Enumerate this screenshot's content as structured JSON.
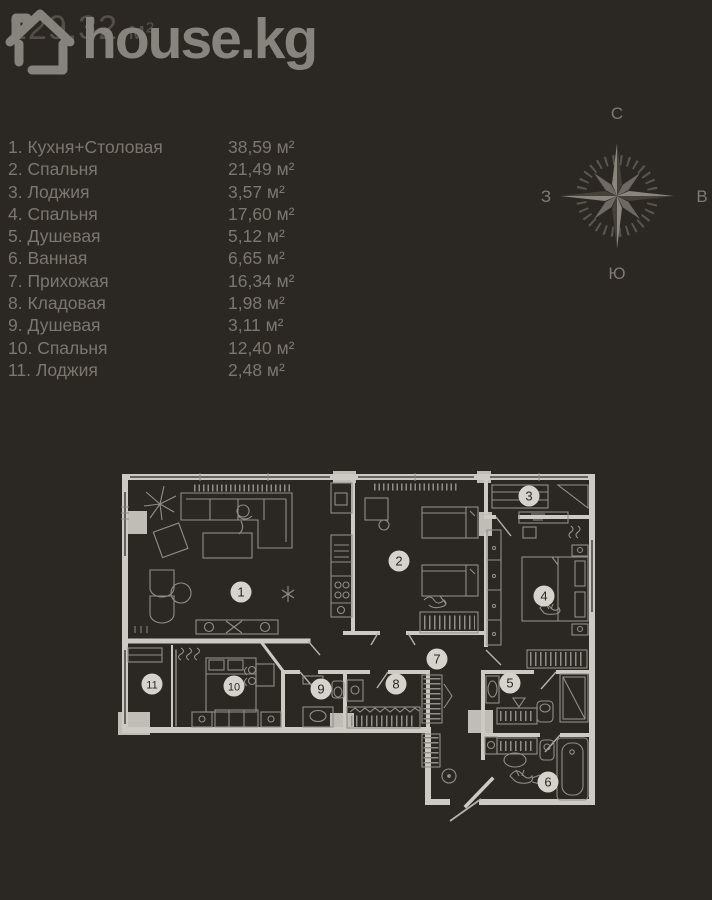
{
  "header": {
    "area_value": "129,32",
    "area_unit": "м²",
    "brand": "house.kg"
  },
  "compass": {
    "north": "С",
    "east": "В",
    "south": "Ю",
    "west": "З"
  },
  "rooms": [
    {
      "num": "1",
      "name": "Кухня+Столовая",
      "area": "38,59 м²",
      "x": 241,
      "y": 592
    },
    {
      "num": "2",
      "name": "Спальня",
      "area": "21,49 м²",
      "x": 399,
      "y": 561
    },
    {
      "num": "3",
      "name": "Лоджия",
      "area": "3,57 м²",
      "x": 529,
      "y": 496
    },
    {
      "num": "4",
      "name": "Спальня",
      "area": "17,60 м²",
      "x": 544,
      "y": 596
    },
    {
      "num": "5",
      "name": "Душевая",
      "area": "5,12 м²",
      "x": 510,
      "y": 683
    },
    {
      "num": "6",
      "name": "Ванная",
      "area": "6,65 м²",
      "x": 548,
      "y": 782
    },
    {
      "num": "7",
      "name": "Прихожая",
      "area": "16,34 м²",
      "x": 437,
      "y": 659
    },
    {
      "num": "8",
      "name": "Кладовая",
      "area": "1,98 м²",
      "x": 396,
      "y": 684
    },
    {
      "num": "9",
      "name": "Душевая",
      "area": "3,11 м²",
      "x": 321,
      "y": 689
    },
    {
      "num": "10",
      "name": "Спальня",
      "area": "12,40 м²",
      "x": 234,
      "y": 686
    },
    {
      "num": "11",
      "name": "Лоджия",
      "area": "2,48 м²",
      "x": 152,
      "y": 684
    }
  ],
  "colors": {
    "bg": "#2b2723",
    "text": "#7b776f",
    "dim": "#534e47",
    "wm": "#8b8781",
    "wall": "#cdcac4",
    "pier": "#c0bdb7",
    "furn": "#918e87",
    "circle": "#d6d3cd",
    "compass": "#7f7b73"
  }
}
